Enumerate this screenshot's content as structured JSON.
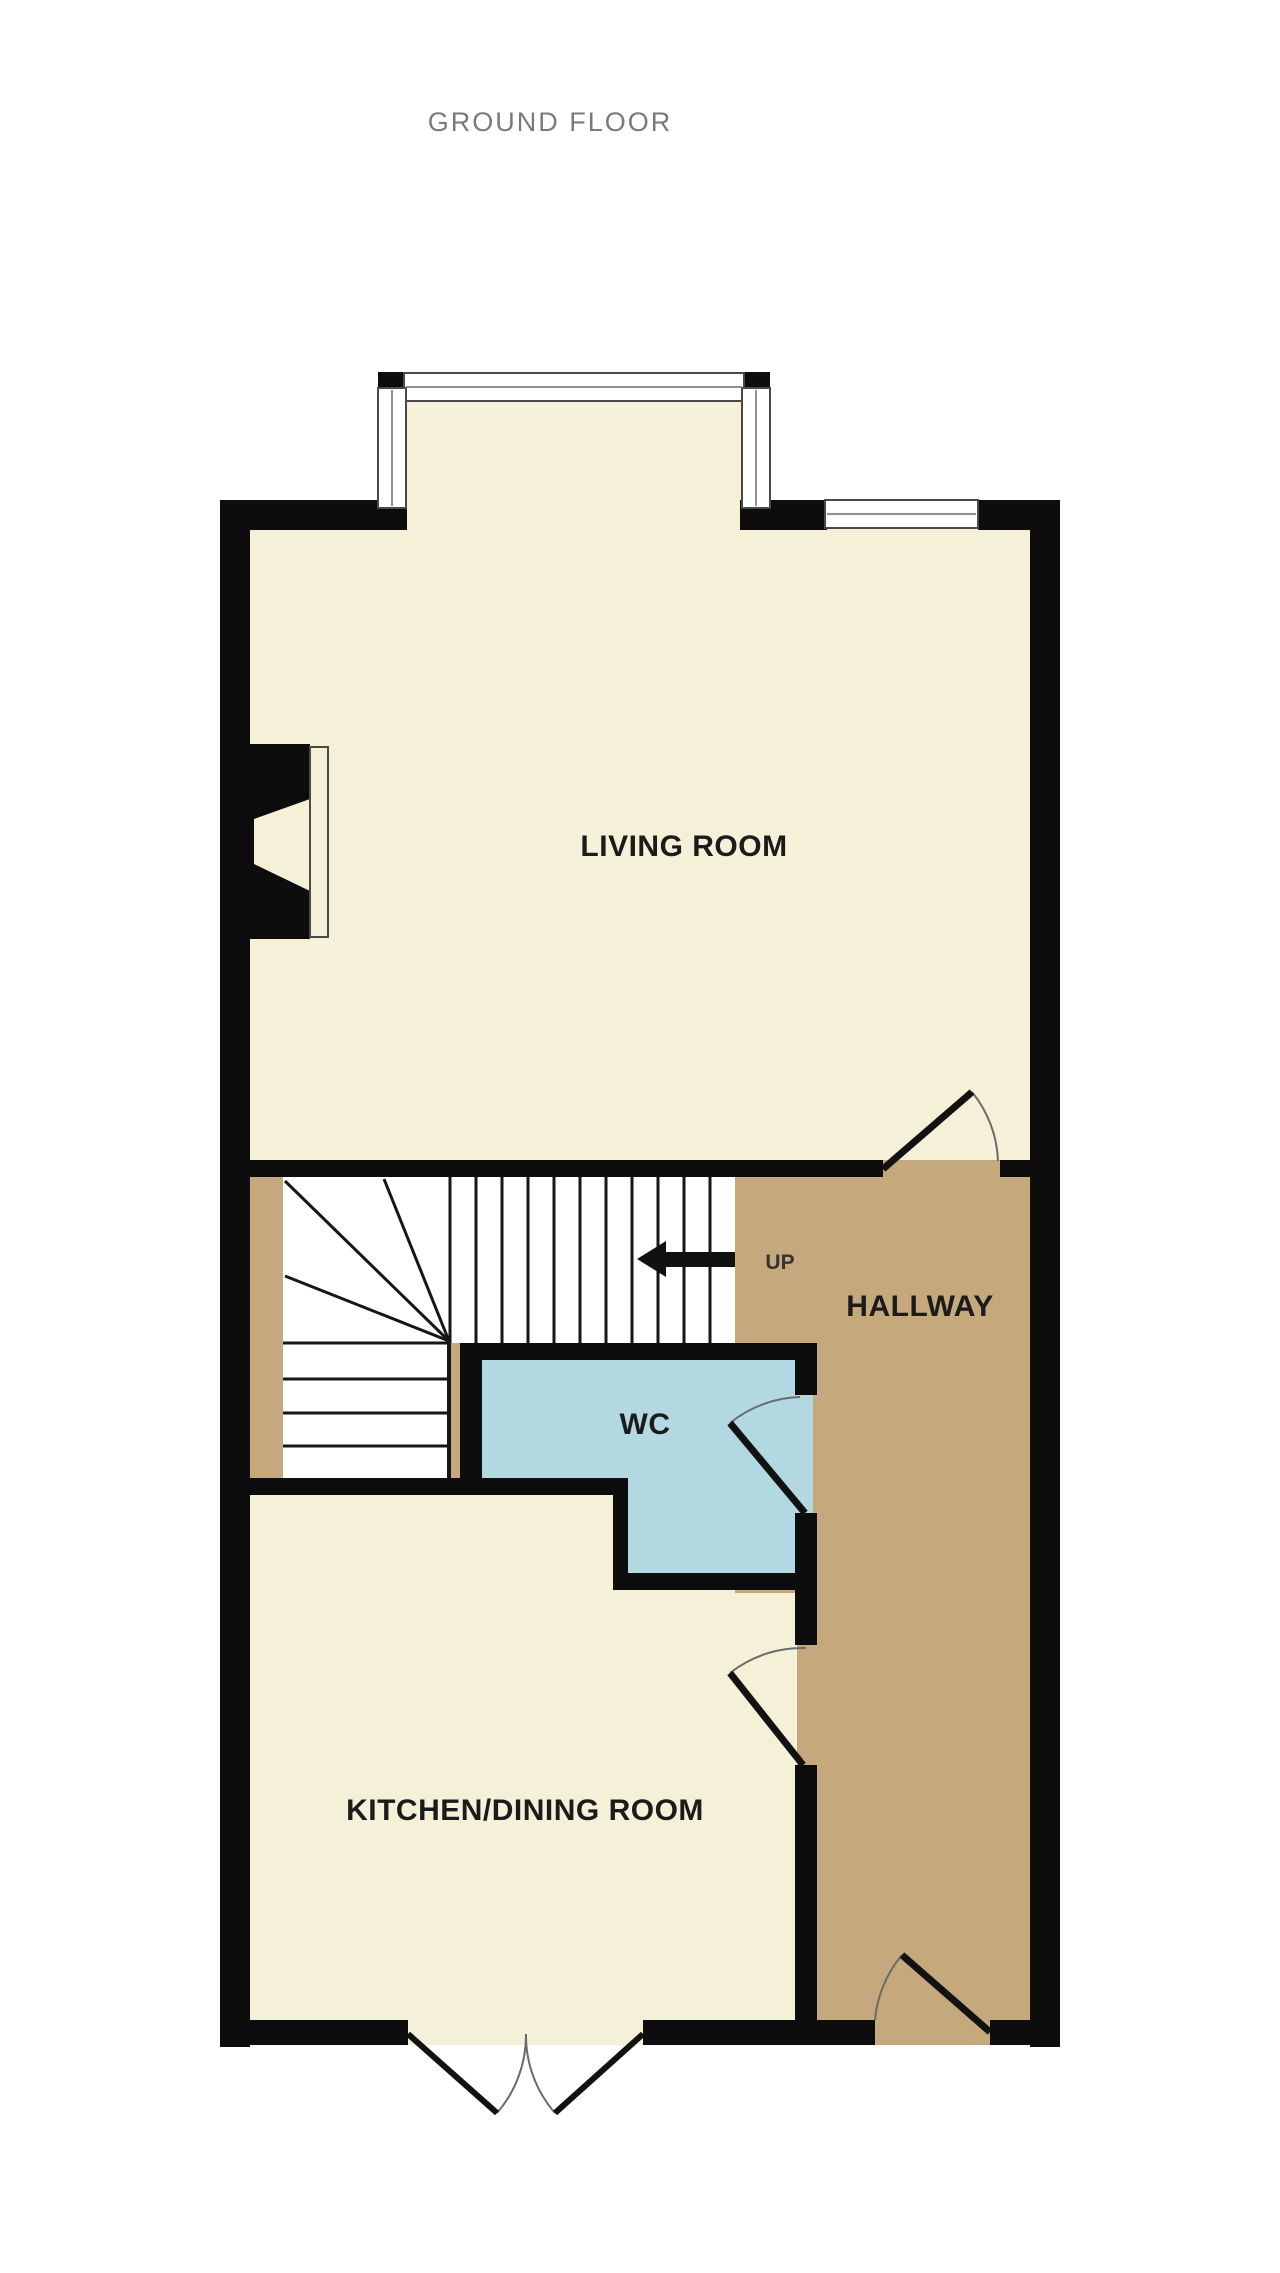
{
  "title": "GROUND FLOOR",
  "rooms": {
    "living_room": "LIVING ROOM",
    "hallway": "HALLWAY",
    "wc": "WC",
    "kitchen_dining": "KITCHEN/DINING ROOM"
  },
  "stairs": {
    "direction_label": "UP"
  },
  "colors": {
    "wall": "#0d0d0d",
    "room_cream": "#f5f1d8",
    "hallway_tan": "#c5a87b",
    "wc_blue": "#b2d9e2",
    "stair_white": "#ffffff",
    "window_white": "#ffffff",
    "title_gray": "#7a7a7a",
    "label_dark": "#1b1b1b",
    "arrow_dark": "#111111"
  }
}
